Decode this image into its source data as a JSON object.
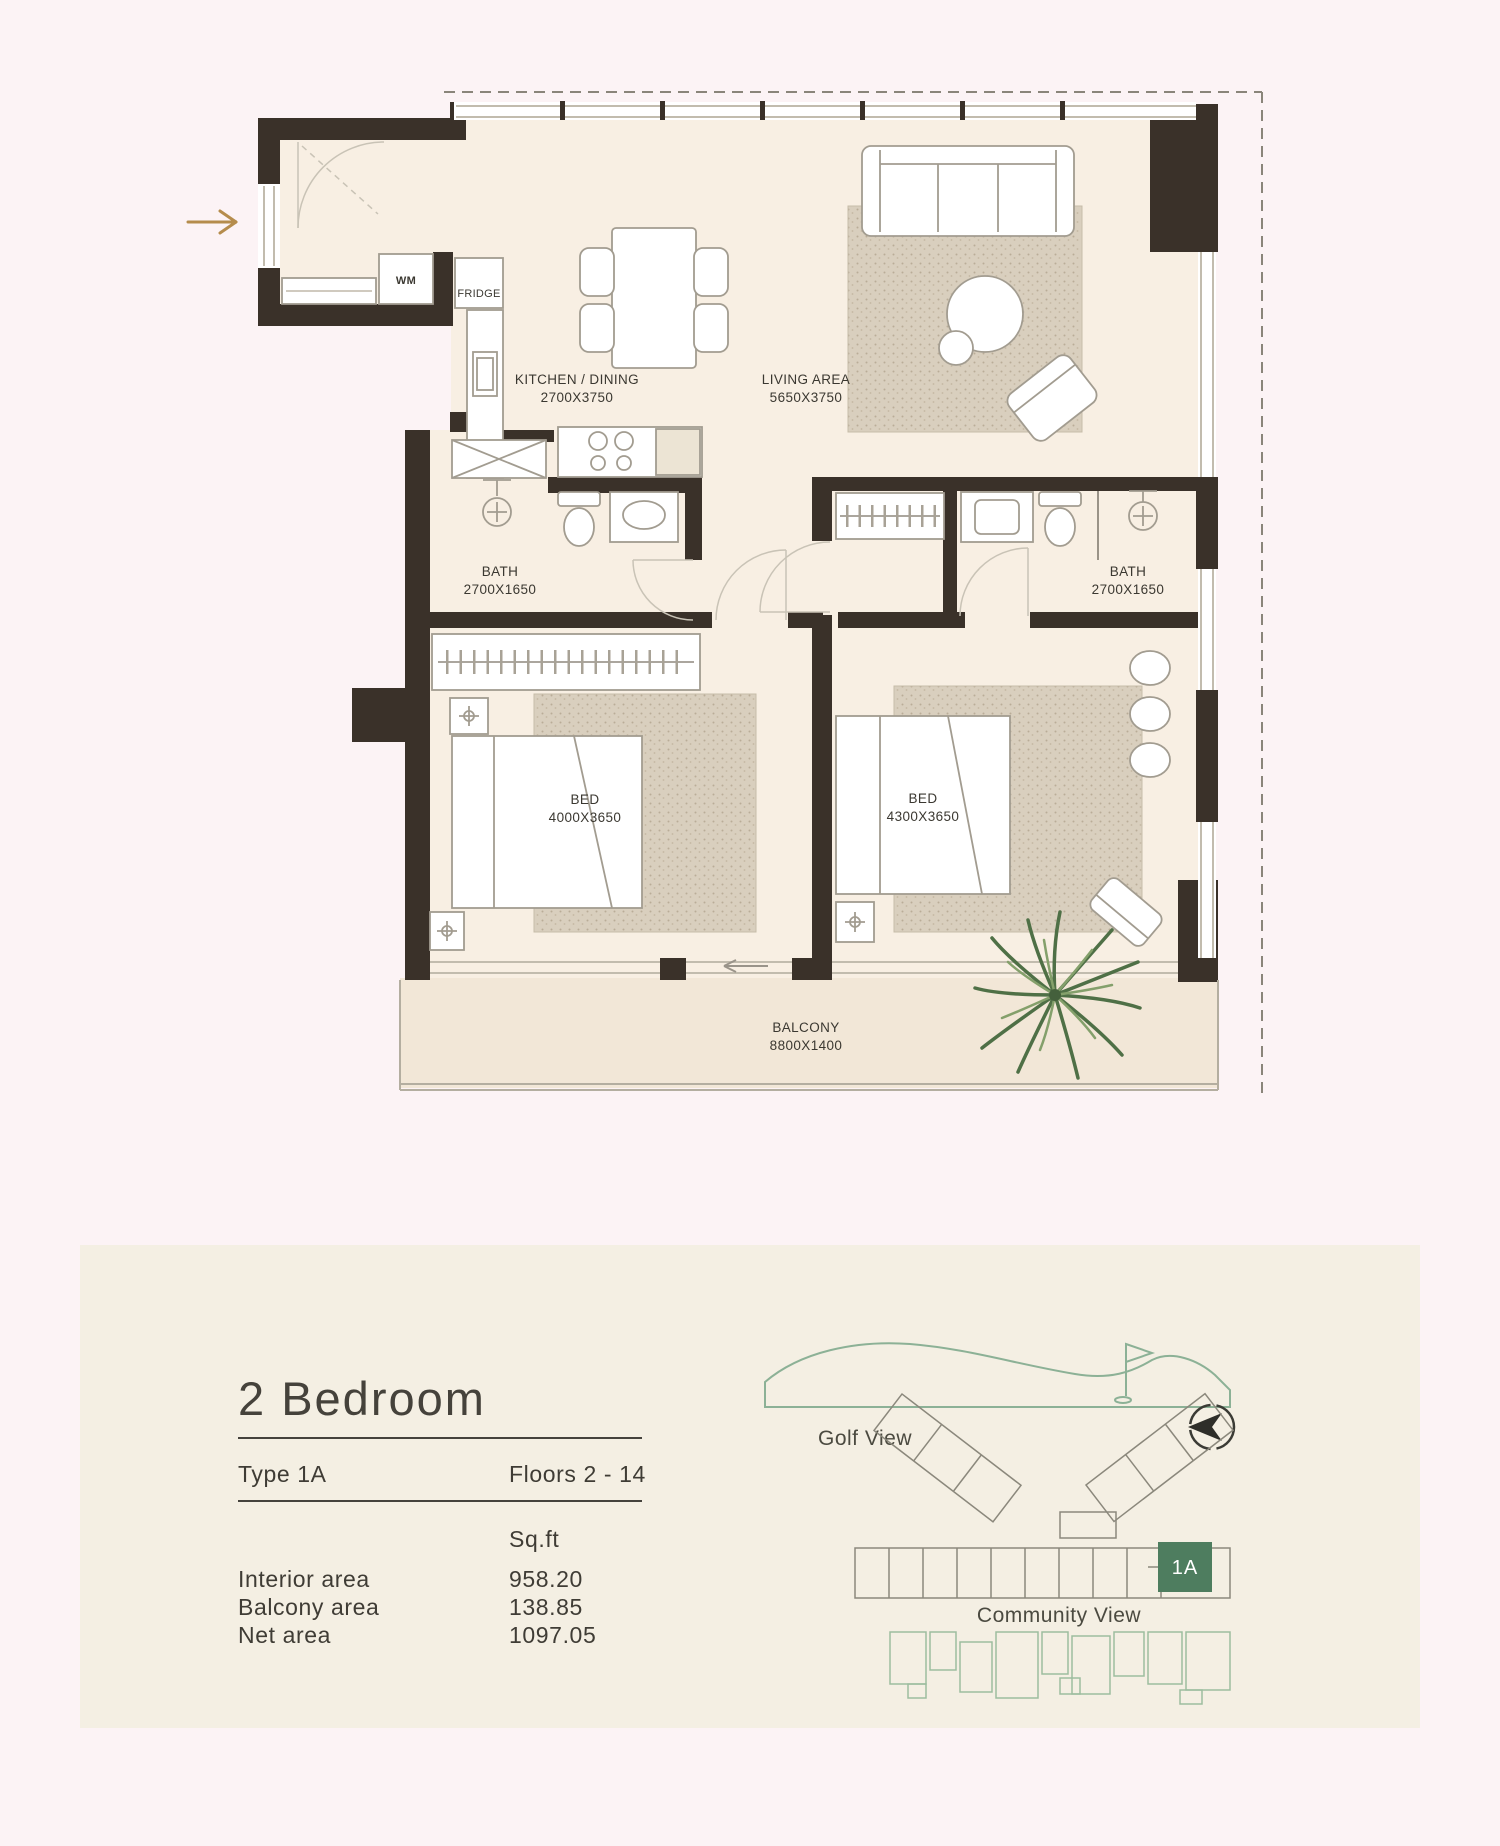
{
  "page": {
    "background": "#fcf3f5"
  },
  "floor_plan": {
    "wall_color": "#3a3129",
    "floor_color": "#f8efe3",
    "balcony_floor_color": "#f2e7d7",
    "accent_gold": "#b58c4c",
    "labels": {
      "wm": "WM",
      "fridge": "FRIDGE",
      "kitchen_name": "KITCHEN / DINING",
      "kitchen_dims": "2700X3750",
      "living_name": "LIVING AREA",
      "living_dims": "5650X3750",
      "bath1_name": "BATH",
      "bath1_dims": "2700X1650",
      "bath2_name": "BATH",
      "bath2_dims": "2700X1650",
      "bed1_name": "BED",
      "bed1_dims": "4000X3650",
      "bed2_name": "BED",
      "bed2_dims": "4300X3650",
      "balcony_name": "BALCONY",
      "balcony_dims": "8800X1400"
    }
  },
  "info_panel": {
    "background": "#f4efe3",
    "title": "2 Bedroom",
    "type_label": "Type 1A",
    "floors_label": "Floors 2 - 14",
    "unit_header": "Sq.ft",
    "areas": [
      {
        "label": "Interior area",
        "value": "958.20"
      },
      {
        "label": "Balcony area",
        "value": "138.85"
      },
      {
        "label": "Net area",
        "value": "1097.05"
      }
    ]
  },
  "site_map": {
    "golf_label": "Golf View",
    "community_label": "Community View",
    "unit_badge": "1A",
    "outline_green": "#8cb196",
    "badge_green": "#4e7d5f"
  }
}
